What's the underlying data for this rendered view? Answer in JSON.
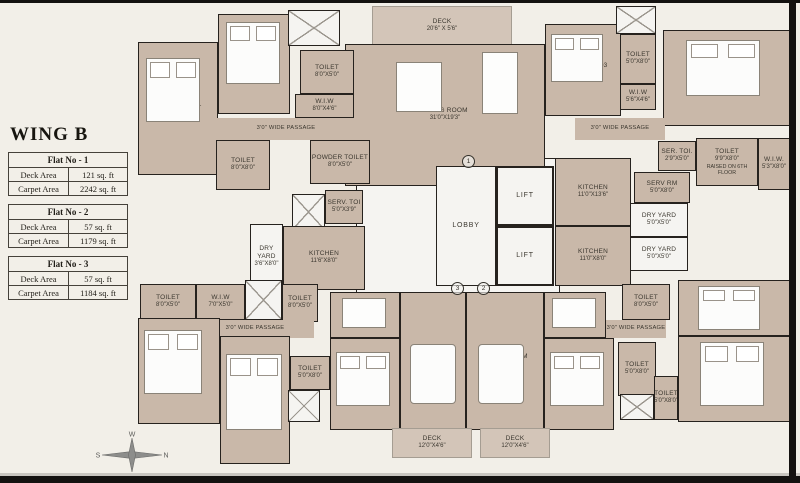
{
  "left_panel": {
    "title": "WING B",
    "flats": [
      {
        "title": "Flat No - 1",
        "rows": [
          {
            "k": "Deck Area",
            "v": "121 sq. ft"
          },
          {
            "k": "Carpet Area",
            "v": "2242 sq. ft"
          }
        ]
      },
      {
        "title": "Flat No - 2",
        "rows": [
          {
            "k": "Deck Area",
            "v": "57 sq. ft"
          },
          {
            "k": "Carpet Area",
            "v": "1179 sq. ft"
          }
        ]
      },
      {
        "title": "Flat No - 3",
        "rows": [
          {
            "k": "Deck Area",
            "v": "57 sq. ft"
          },
          {
            "k": "Carpet Area",
            "v": "1184 sq. ft"
          }
        ]
      }
    ]
  },
  "compass": {
    "n": "N",
    "s": "S",
    "e": "E",
    "w": "W"
  },
  "colors": {
    "wall": "#26221e",
    "room_fill": "#c9b8a9",
    "background": "#f2efe8",
    "service_fill": "#f5f4f1",
    "deck_fill": "#d3c5b8"
  },
  "plan": {
    "rooms": [
      {
        "id": "core-open-area",
        "type": "white",
        "x": 356,
        "y": 158,
        "w": 204,
        "h": 144
      },
      {
        "id": "deck-top",
        "type": "deck",
        "label": "DECK",
        "dims": "20'6\" X 5'6\"",
        "x": 372,
        "y": 6,
        "w": 140,
        "h": 40
      },
      {
        "id": "living-room-1",
        "type": "tan",
        "label": "LIVING ROOM",
        "dims": "31'0\"X19'3\"",
        "x": 345,
        "y": 44,
        "w": 200,
        "h": 142
      },
      {
        "id": "bedroom-1",
        "type": "tan",
        "label": "BED ROOM - 1",
        "dims": "11'0\"X18'9\"",
        "x": 138,
        "y": 42,
        "w": 80,
        "h": 133
      },
      {
        "id": "bedroom-2",
        "type": "tan",
        "label": "BED ROOM - 2",
        "dims": "11'0\"X15'0\"",
        "x": 218,
        "y": 14,
        "w": 72,
        "h": 100
      },
      {
        "id": "stairs-top-left",
        "type": "stairs",
        "x": 288,
        "y": 10,
        "w": 52,
        "h": 36
      },
      {
        "id": "toilet-bed2",
        "type": "tan",
        "label": "TOILET",
        "dims": "8'0\"X5'0\"",
        "x": 300,
        "y": 50,
        "w": 54,
        "h": 44
      },
      {
        "id": "wiw-bed2",
        "type": "tan",
        "label": "W.I.W",
        "dims": "8'0\"X4'6\"",
        "x": 295,
        "y": 94,
        "w": 59,
        "h": 24
      },
      {
        "id": "passage-top-left",
        "type": "passage",
        "label": "3'0\" WIDE PASSAGE",
        "x": 216,
        "y": 118,
        "w": 140,
        "h": 22
      },
      {
        "id": "toilet-bed1",
        "type": "tan",
        "label": "TOILET",
        "dims": "8'0\"X8'0\"",
        "x": 216,
        "y": 140,
        "w": 54,
        "h": 50
      },
      {
        "id": "powder-toilet",
        "type": "tan",
        "label": "POWDER TOILET",
        "dims": "8'0\"X5'0\"",
        "x": 310,
        "y": 140,
        "w": 60,
        "h": 44
      },
      {
        "id": "bedroom-3",
        "type": "tan",
        "label": "BEDROOM - 03",
        "dims": "11'0\"X13'0\"",
        "x": 545,
        "y": 24,
        "w": 76,
        "h": 92
      },
      {
        "id": "stairs-top-right",
        "type": "stairs",
        "x": 616,
        "y": 6,
        "w": 40,
        "h": 28
      },
      {
        "id": "toilet-bed3",
        "type": "tan",
        "label": "TOILET",
        "dims": "5'0\"X8'0\"",
        "x": 620,
        "y": 34,
        "w": 36,
        "h": 50
      },
      {
        "id": "wiw-bed3",
        "type": "tan",
        "label": "W.I.W",
        "dims": "5'6\"X4'6\"",
        "x": 620,
        "y": 84,
        "w": 36,
        "h": 26
      },
      {
        "id": "bedroom-4",
        "type": "tan",
        "label": "BEDROOM - 04",
        "dims": "20'6\"X15'0\"",
        "x": 663,
        "y": 30,
        "w": 127,
        "h": 96
      },
      {
        "id": "passage-top-right",
        "type": "passage",
        "label": "3'0\" WIDE PASSAGE",
        "x": 575,
        "y": 118,
        "w": 90,
        "h": 22
      },
      {
        "id": "servant-toilet-1",
        "type": "tan",
        "label": "SERV. TOI",
        "dims": "5'0\"X3'9\"",
        "x": 325,
        "y": 190,
        "w": 38,
        "h": 34
      },
      {
        "id": "stairs-mid",
        "type": "stairs",
        "x": 292,
        "y": 194,
        "w": 33,
        "h": 36
      },
      {
        "id": "dry-yard-1",
        "type": "white",
        "label": "DRY YARD",
        "dims": "3'6\"X8'0\"",
        "x": 250,
        "y": 224,
        "w": 33,
        "h": 66
      },
      {
        "id": "kitchen-1",
        "type": "tan",
        "label": "KITCHEN",
        "dims": "11'6\"X8'0\"",
        "x": 283,
        "y": 226,
        "w": 82,
        "h": 64
      },
      {
        "id": "lobby",
        "type": "white lobby-room",
        "label": "LOBBY",
        "x": 436,
        "y": 166,
        "w": 60,
        "h": 120
      },
      {
        "id": "lift-1",
        "type": "lift",
        "label": "LIFT",
        "x": 496,
        "y": 166,
        "w": 58,
        "h": 60
      },
      {
        "id": "lift-2",
        "type": "lift",
        "label": "LIFT",
        "x": 496,
        "y": 226,
        "w": 58,
        "h": 60
      },
      {
        "id": "kitchen-2",
        "type": "tan",
        "label": "KITCHEN",
        "dims": "11'0\"X13'6\"",
        "x": 555,
        "y": 158,
        "w": 76,
        "h": 68
      },
      {
        "id": "kitchen-3",
        "type": "tan",
        "label": "KITCHEN",
        "dims": "11'0\"X8'0\"",
        "x": 555,
        "y": 226,
        "w": 76,
        "h": 60
      },
      {
        "id": "servant-toilet-2",
        "type": "tan",
        "label": "SER. TOI.",
        "dims": "2'9\"X5'0\"",
        "x": 658,
        "y": 141,
        "w": 38,
        "h": 30
      },
      {
        "id": "toilet-raised",
        "type": "tan",
        "label": "TOILET",
        "dims": "9'9\"X8'0\"",
        "note": "RAISED ON 6TH FLOOR",
        "x": 696,
        "y": 138,
        "w": 62,
        "h": 48
      },
      {
        "id": "wiw-right",
        "type": "tan",
        "label": "W.I.W.",
        "dims": "5'3\"X8'0\"",
        "x": 758,
        "y": 138,
        "w": 32,
        "h": 52
      },
      {
        "id": "servant-room",
        "type": "tan",
        "label": "SERV RM",
        "dims": "5'0\"X8'0\"",
        "x": 634,
        "y": 172,
        "w": 56,
        "h": 31
      },
      {
        "id": "dry-yard-2",
        "type": "white",
        "label": "DRY YARD",
        "dims": "5'0\"X5'0\"",
        "x": 630,
        "y": 203,
        "w": 58,
        "h": 34
      },
      {
        "id": "dry-yard-3",
        "type": "white",
        "label": "DRY YARD",
        "dims": "5'0\"X5'0\"",
        "x": 630,
        "y": 237,
        "w": 58,
        "h": 34
      },
      {
        "id": "toilet-bottom-left",
        "type": "tan",
        "label": "TOILET",
        "dims": "8'0\"X5'0\"",
        "x": 140,
        "y": 284,
        "w": 56,
        "h": 36
      },
      {
        "id": "wiw-bottom-left",
        "type": "tan",
        "label": "W.I.W",
        "dims": "7'0\"X5'0\"",
        "x": 196,
        "y": 284,
        "w": 49,
        "h": 36
      },
      {
        "id": "stairs-bottom-left",
        "type": "stairs",
        "x": 245,
        "y": 280,
        "w": 37,
        "h": 40
      },
      {
        "id": "toilet-bottom-center-1",
        "type": "tan",
        "label": "TOILET",
        "dims": "8'0\"X5'0\"",
        "x": 282,
        "y": 284,
        "w": 36,
        "h": 38
      },
      {
        "id": "passage-bottom-left",
        "type": "passage",
        "label": "3'0\" WIDE PASSAGE",
        "x": 196,
        "y": 320,
        "w": 118,
        "h": 18
      },
      {
        "id": "bedroom-bottom-left-1",
        "type": "tan",
        "label": "BED ROOM",
        "dims": "11'0\"X15'0\"",
        "x": 138,
        "y": 318,
        "w": 82,
        "h": 106
      },
      {
        "id": "bedroom-bottom-left-2",
        "type": "tan",
        "label": "BED ROOM",
        "dims": "11'0\"X15'0\"",
        "x": 220,
        "y": 336,
        "w": 70,
        "h": 128
      },
      {
        "id": "toilet-bottom-center-2",
        "type": "tan",
        "label": "TOILET",
        "dims": "5'0\"X8'0\"",
        "x": 290,
        "y": 356,
        "w": 40,
        "h": 34
      },
      {
        "id": "stairs-bottom-center",
        "type": "stairs",
        "x": 288,
        "y": 390,
        "w": 32,
        "h": 32
      },
      {
        "id": "dining-1",
        "type": "tan",
        "label": "DINING",
        "dims": "8'6\"X8'3\"",
        "x": 330,
        "y": 292,
        "w": 70,
        "h": 46
      },
      {
        "id": "bedroom-bottom-center",
        "type": "tan",
        "label": "BED ROOM",
        "dims": "12'0\"X13'0\"",
        "x": 330,
        "y": 338,
        "w": 70,
        "h": 92
      },
      {
        "id": "living-room-2",
        "type": "tan",
        "label": "LIVING ROOM",
        "dims": "12'0\"X21'9\"",
        "x": 400,
        "y": 292,
        "w": 66,
        "h": 138
      },
      {
        "id": "living-room-3",
        "type": "tan",
        "label": "LIVING ROOM",
        "dims": "12'0\"X21'9\"",
        "x": 466,
        "y": 292,
        "w": 78,
        "h": 138
      },
      {
        "id": "dining-2",
        "type": "tan",
        "label": "DINING",
        "dims": "13'0\"X8'3\"",
        "x": 544,
        "y": 292,
        "w": 62,
        "h": 46
      },
      {
        "id": "bedroom-bottom-right-center",
        "type": "tan",
        "label": "BED ROOM",
        "dims": "10'0\"X13'0\"",
        "x": 544,
        "y": 338,
        "w": 70,
        "h": 92
      },
      {
        "id": "toilet-bottom-right-1",
        "type": "tan",
        "label": "TOILET",
        "dims": "8'0\"X5'0\"",
        "x": 622,
        "y": 284,
        "w": 48,
        "h": 36
      },
      {
        "id": "passage-bottom-right",
        "type": "passage",
        "label": "3'0\" WIDE PASSAGE",
        "x": 606,
        "y": 320,
        "w": 60,
        "h": 18
      },
      {
        "id": "bedroom-bottom-right-1",
        "type": "tan",
        "label": "BED ROOM",
        "dims": "10'0\"X11'6\"",
        "x": 678,
        "y": 280,
        "w": 112,
        "h": 56
      },
      {
        "id": "bedroom-bottom-right-2",
        "type": "tan",
        "label": "BED ROOM",
        "dims": "10'0\"X11'6\"",
        "x": 678,
        "y": 336,
        "w": 112,
        "h": 86
      },
      {
        "id": "toilet-bottom-right-2",
        "type": "tan",
        "label": "TOILET",
        "dims": "5'0\"X8'0\"",
        "x": 618,
        "y": 342,
        "w": 38,
        "h": 54
      },
      {
        "id": "toilet-bottom-right-3",
        "type": "tan",
        "label": "TOILET",
        "dims": "5'0\"X8'0\"",
        "x": 654,
        "y": 376,
        "w": 24,
        "h": 44
      },
      {
        "id": "stairs-bottom-right",
        "type": "stairs",
        "x": 620,
        "y": 394,
        "w": 34,
        "h": 26
      },
      {
        "id": "deck-bottom-left",
        "type": "deck",
        "label": "DECK",
        "dims": "12'0\"X4'6\"",
        "x": 392,
        "y": 428,
        "w": 80,
        "h": 30
      },
      {
        "id": "deck-bottom-right",
        "type": "deck",
        "label": "DECK",
        "dims": "12'0\"X4'6\"",
        "x": 480,
        "y": 428,
        "w": 70,
        "h": 30
      }
    ],
    "markers": [
      {
        "n": "1",
        "x": 462,
        "y": 155
      },
      {
        "n": "2",
        "x": 477,
        "y": 282
      },
      {
        "n": "3",
        "x": 451,
        "y": 282
      }
    ],
    "furniture": [
      {
        "type": "bed",
        "x": 146,
        "y": 58,
        "w": 54,
        "h": 64
      },
      {
        "type": "bed",
        "x": 226,
        "y": 22,
        "w": 54,
        "h": 62
      },
      {
        "type": "bed",
        "x": 551,
        "y": 34,
        "w": 52,
        "h": 48
      },
      {
        "type": "bed",
        "x": 686,
        "y": 40,
        "w": 74,
        "h": 56
      },
      {
        "type": "bed",
        "x": 144,
        "y": 330,
        "w": 58,
        "h": 64
      },
      {
        "type": "bed",
        "x": 226,
        "y": 354,
        "w": 56,
        "h": 76
      },
      {
        "type": "bed",
        "x": 336,
        "y": 352,
        "w": 54,
        "h": 54
      },
      {
        "type": "bed",
        "x": 550,
        "y": 352,
        "w": 54,
        "h": 54
      },
      {
        "type": "bed",
        "x": 698,
        "y": 286,
        "w": 62,
        "h": 44
      },
      {
        "type": "bed",
        "x": 700,
        "y": 342,
        "w": 64,
        "h": 64
      },
      {
        "type": "table",
        "x": 396,
        "y": 62,
        "w": 46,
        "h": 50
      },
      {
        "type": "table",
        "x": 482,
        "y": 52,
        "w": 36,
        "h": 62
      },
      {
        "type": "sofa",
        "x": 410,
        "y": 344,
        "w": 46,
        "h": 60
      },
      {
        "type": "sofa",
        "x": 478,
        "y": 344,
        "w": 46,
        "h": 60
      },
      {
        "type": "table",
        "x": 342,
        "y": 298,
        "w": 44,
        "h": 30
      },
      {
        "type": "table",
        "x": 552,
        "y": 298,
        "w": 44,
        "h": 30
      }
    ]
  }
}
